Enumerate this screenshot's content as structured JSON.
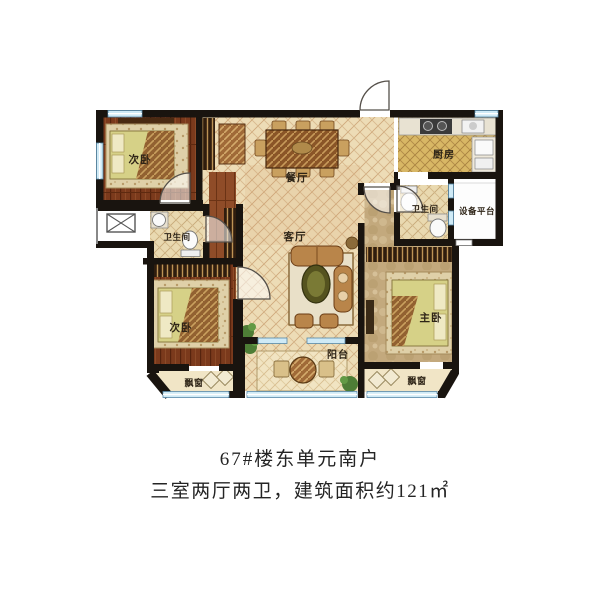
{
  "caption": {
    "line1": "67#楼东单元南户",
    "line2": "三室两厅两卫，建筑面积约121㎡"
  },
  "floorplan": {
    "rooms": {
      "bedroom_top_left": "次卧",
      "bedroom_bottom_left": "次卧",
      "dining": "餐厅",
      "living": "客厅",
      "kitchen": "厨房",
      "bathroom_left": "卫生间",
      "bathroom_right": "卫生间",
      "equipment_platform": "设备平台",
      "master_bedroom": "主卧",
      "balcony": "阳台",
      "bay_window_left": "飘窗",
      "bay_window_right": "飘窗"
    },
    "colors": {
      "wall": "#19140f",
      "window_blue": "#cfeaf6",
      "floor_wood_dark": "#7b3a1c",
      "floor_hall_wood": "#8f4c28",
      "floor_lattice_beige": "#eddcb6",
      "floor_lattice_gold": "#d8b765",
      "floor_master_tan": "#c3a97d",
      "bed_yellow": "#d6d187",
      "sofa_brown": "#b9854a",
      "plant_green": "#4e7d36"
    }
  }
}
